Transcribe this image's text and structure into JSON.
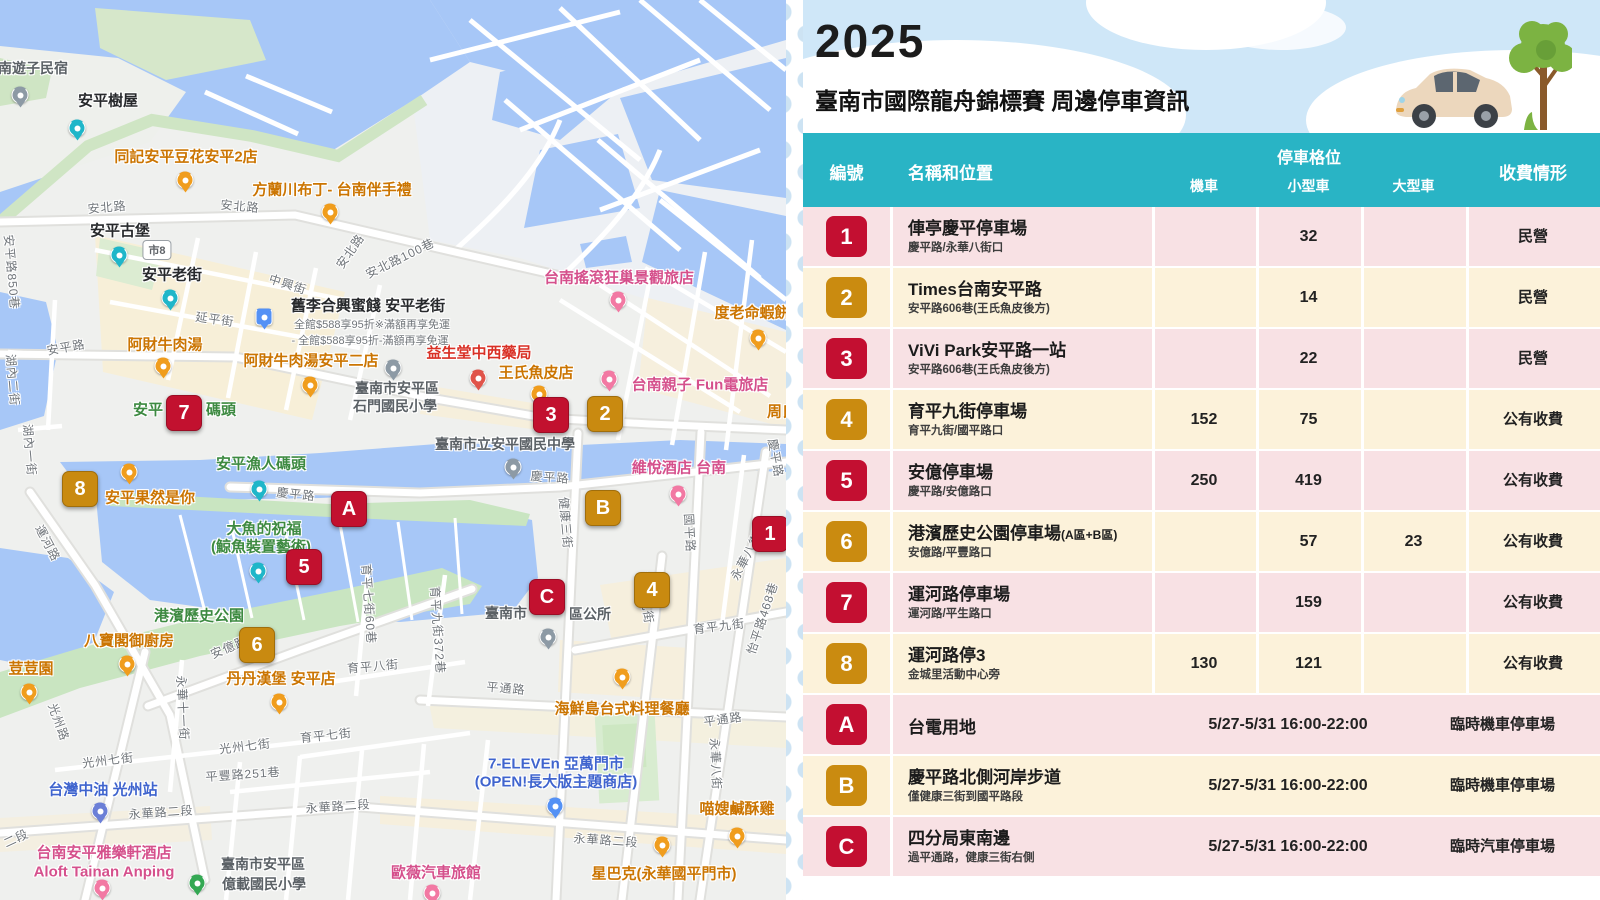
{
  "poster": {
    "year": "2025",
    "title": "臺南市國際龍舟錦標賽 周邊停車資訊",
    "header": {
      "id": "編號",
      "name": "名稱和位置",
      "group": "停車格位",
      "moto": "機車",
      "small": "小型車",
      "large": "大型車",
      "fee": "收費情形"
    },
    "colors": {
      "teal": "#29b4c5",
      "badge_red": "#c30f31",
      "badge_gold": "#ca8b10",
      "row_pink": "#f8e1e4",
      "row_cream": "#fcf2da",
      "sky": "#cfe7f8"
    },
    "rows": [
      {
        "id": "1",
        "color": "red",
        "name": "俥亭慶平停車場",
        "sub": "慶平路/永華八街口",
        "moto": "",
        "small": "32",
        "large": "",
        "fee": "民營"
      },
      {
        "id": "2",
        "color": "gold",
        "name": "Times台南安平路",
        "sub": "安平路606巷(王氏魚皮後方)",
        "moto": "",
        "small": "14",
        "large": "",
        "fee": "民營"
      },
      {
        "id": "3",
        "color": "red",
        "name": "ViVi Park安平路一站",
        "sub": "安平路606巷(王氏魚皮後方)",
        "moto": "",
        "small": "22",
        "large": "",
        "fee": "民營"
      },
      {
        "id": "4",
        "color": "gold",
        "name": "育平九街停車場",
        "sub": "育平九街/國平路口",
        "moto": "152",
        "small": "75",
        "large": "",
        "fee": "公有收費"
      },
      {
        "id": "5",
        "color": "red",
        "name": "安億停車場",
        "sub": "慶平路/安億路口",
        "moto": "250",
        "small": "419",
        "large": "",
        "fee": "公有收費"
      },
      {
        "id": "6",
        "color": "gold",
        "name": "港濱歷史公園停車場",
        "name_suffix": "(A區+B區)",
        "sub": "安億路/平豐路口",
        "moto": "",
        "small": "57",
        "large": "23",
        "fee": "公有收費"
      },
      {
        "id": "7",
        "color": "red",
        "name": "運河路停車場",
        "sub": "運河路/平生路口",
        "moto": "",
        "small": "159",
        "large": "",
        "fee": "公有收費"
      },
      {
        "id": "8",
        "color": "gold",
        "name": "運河路停3",
        "sub": "金城里活動中心旁",
        "moto": "130",
        "small": "121",
        "large": "",
        "fee": "公有收費"
      },
      {
        "id": "A",
        "color": "red",
        "name": "台電用地",
        "sub": "",
        "time": "5/27-5/31 16:00-22:00",
        "fee": "臨時機車停車場"
      },
      {
        "id": "B",
        "color": "gold",
        "name": "慶平路北側河岸步道",
        "sub": "僅健康三街到國平路段",
        "time": "5/27-5/31 16:00-22:00",
        "fee": "臨時機車停車場"
      },
      {
        "id": "C",
        "color": "red",
        "name": "四分局東南邊",
        "sub": "過平通路，健康三街右側",
        "time": "5/27-5/31 16:00-22:00",
        "fee": "臨時汽車停車場"
      }
    ],
    "illustration": [
      "car-illustration",
      "tree-illustration"
    ]
  },
  "map": {
    "shield": {
      "text": "市8",
      "x": 157,
      "y": 250
    },
    "markers": [
      {
        "label": "1",
        "color": "red",
        "x": 770,
        "y": 534
      },
      {
        "label": "2",
        "color": "gold",
        "x": 605,
        "y": 414
      },
      {
        "label": "3",
        "color": "red",
        "x": 551,
        "y": 415
      },
      {
        "label": "4",
        "color": "gold",
        "x": 652,
        "y": 590
      },
      {
        "label": "5",
        "color": "red",
        "x": 304,
        "y": 567
      },
      {
        "label": "6",
        "color": "gold",
        "x": 257,
        "y": 645
      },
      {
        "label": "7",
        "color": "red",
        "x": 184,
        "y": 413
      },
      {
        "label": "8",
        "color": "gold",
        "x": 80,
        "y": 489
      },
      {
        "label": "A",
        "color": "red",
        "x": 349,
        "y": 509
      },
      {
        "label": "B",
        "color": "gold",
        "x": 603,
        "y": 508
      },
      {
        "label": "C",
        "color": "red",
        "x": 547,
        "y": 597
      }
    ],
    "labels": [
      {
        "t": "安北路",
        "x": 107,
        "y": 207,
        "c": "road",
        "r": -5
      },
      {
        "t": "安北路",
        "x": 240,
        "y": 206,
        "c": "road",
        "r": 5
      },
      {
        "t": "安北路",
        "x": 350,
        "y": 251,
        "c": "road",
        "r": -55
      },
      {
        "t": "安北路100巷",
        "x": 400,
        "y": 258,
        "c": "road",
        "r": -26
      },
      {
        "t": "中興街",
        "x": 288,
        "y": 284,
        "c": "road",
        "r": 18
      },
      {
        "t": "延平街",
        "x": 215,
        "y": 319,
        "c": "road",
        "r": 8
      },
      {
        "t": "安平路850巷",
        "x": 12,
        "y": 272,
        "c": "road",
        "r": 85
      },
      {
        "t": "安平路",
        "x": 66,
        "y": 347,
        "c": "road",
        "r": -10
      },
      {
        "t": "湖內二街",
        "x": 13,
        "y": 380,
        "c": "road",
        "r": 85
      },
      {
        "t": "湖內一街",
        "x": 30,
        "y": 450,
        "c": "road",
        "r": 85
      },
      {
        "t": "運河路",
        "x": 48,
        "y": 543,
        "c": "road",
        "r": 62
      },
      {
        "t": "慶平路",
        "x": 296,
        "y": 494,
        "c": "road",
        "r": 6
      },
      {
        "t": "慶平路",
        "x": 550,
        "y": 477,
        "c": "road",
        "r": 4
      },
      {
        "t": "慶平路",
        "x": 776,
        "y": 458,
        "c": "road",
        "r": 80
      },
      {
        "t": "健康三街",
        "x": 566,
        "y": 523,
        "c": "road",
        "r": 85
      },
      {
        "t": "國平路",
        "x": 690,
        "y": 533,
        "c": "road",
        "r": 87
      },
      {
        "t": "永華八街",
        "x": 746,
        "y": 556,
        "c": "road",
        "r": -62
      },
      {
        "t": "永華八街",
        "x": 716,
        "y": 764,
        "c": "road",
        "r": 87
      },
      {
        "t": "怡平路468巷",
        "x": 762,
        "y": 618,
        "c": "road",
        "r": -72
      },
      {
        "t": "育平九街",
        "x": 719,
        "y": 626,
        "c": "road",
        "r": -7
      },
      {
        "t": "育平九街",
        "x": 646,
        "y": 598,
        "c": "road",
        "r": 82
      },
      {
        "t": "育平九街372巷",
        "x": 438,
        "y": 630,
        "c": "road",
        "r": 86
      },
      {
        "t": "平通路",
        "x": 506,
        "y": 688,
        "c": "road",
        "r": 5
      },
      {
        "t": "平通路",
        "x": 723,
        "y": 719,
        "c": "road",
        "r": -8
      },
      {
        "t": "永華路二段",
        "x": 161,
        "y": 812,
        "c": "road",
        "r": -4
      },
      {
        "t": "永華路二段",
        "x": 338,
        "y": 806,
        "c": "road",
        "r": -4
      },
      {
        "t": "永華路二段",
        "x": 606,
        "y": 840,
        "c": "road",
        "r": 4
      },
      {
        "t": "二段",
        "x": 16,
        "y": 838,
        "c": "road",
        "r": -25
      },
      {
        "t": "光州路",
        "x": 59,
        "y": 722,
        "c": "road",
        "r": 70
      },
      {
        "t": "永華十一街",
        "x": 183,
        "y": 708,
        "c": "road",
        "r": 87
      },
      {
        "t": "光州七街",
        "x": 108,
        "y": 760,
        "c": "road",
        "r": -7
      },
      {
        "t": "光州七街",
        "x": 245,
        "y": 746,
        "c": "road",
        "r": -7
      },
      {
        "t": "平豐路251巷",
        "x": 243,
        "y": 774,
        "c": "road",
        "r": -4
      },
      {
        "t": "育平七街60巷",
        "x": 369,
        "y": 604,
        "c": "road",
        "r": 86
      },
      {
        "t": "育平八街",
        "x": 373,
        "y": 666,
        "c": "road",
        "r": -5
      },
      {
        "t": "育平七街",
        "x": 326,
        "y": 735,
        "c": "road",
        "r": -6
      },
      {
        "t": "安億路",
        "x": 229,
        "y": 647,
        "c": "road",
        "r": -23
      },
      {
        "t": "同記安平豆花安平2店",
        "x": 186,
        "y": 156,
        "c": "food",
        "r": 0
      },
      {
        "t": "方蘭川布丁- 台南伴手禮",
        "x": 332,
        "y": 189,
        "c": "food",
        "r": 0
      },
      {
        "t": "阿財牛肉湯",
        "x": 165,
        "y": 344,
        "c": "food",
        "r": 0
      },
      {
        "t": "阿財牛肉湯安平二店",
        "x": 311,
        "y": 360,
        "c": "food",
        "r": 0
      },
      {
        "t": "王氏魚皮店",
        "x": 536,
        "y": 372,
        "c": "food",
        "r": 0
      },
      {
        "t": "度老命蝦餅",
        "x": 752,
        "y": 312,
        "c": "food",
        "r": 0
      },
      {
        "t": "海鮮島台式料理餐廳",
        "x": 622,
        "y": 708,
        "c": "food",
        "r": 0
      },
      {
        "t": "八寶閣御廚房",
        "x": 129,
        "y": 640,
        "c": "food",
        "r": 0
      },
      {
        "t": "荳荳園",
        "x": 31,
        "y": 668,
        "c": "food",
        "r": 0
      },
      {
        "t": "丹丹漢堡 安平店",
        "x": 281,
        "y": 678,
        "c": "food",
        "r": 0
      },
      {
        "t": "喵嫂鹹酥雞",
        "x": 737,
        "y": 808,
        "c": "food",
        "r": 0
      },
      {
        "t": "星巴克(永華國平門市)",
        "x": 664,
        "y": 873,
        "c": "food",
        "r": 0
      },
      {
        "t": "安平果然是你",
        "x": 150,
        "y": 497,
        "c": "food",
        "r": 0
      },
      {
        "t": "周氏",
        "x": 782,
        "y": 411,
        "c": "food",
        "r": 0
      },
      {
        "t": "益生堂中西藥局",
        "x": 479,
        "y": 352,
        "c": "red",
        "r": 0
      },
      {
        "t": "台南搖滾狂巢景觀旅店",
        "x": 619,
        "y": 277,
        "c": "hotel",
        "r": 0
      },
      {
        "t": "台南親子 Fun電旅店",
        "x": 700,
        "y": 384,
        "c": "hotel",
        "r": 0
      },
      {
        "t": "維悅酒店 台南",
        "x": 679,
        "y": 467,
        "c": "hotel",
        "r": 0
      },
      {
        "t": "歐薇汽車旅館",
        "x": 436,
        "y": 872,
        "c": "hotel",
        "r": 0
      },
      {
        "t": "台南安平雅樂軒酒店",
        "x": 104,
        "y": 852,
        "c": "hotel",
        "r": 0
      },
      {
        "t": "Aloft Tainan Anping",
        "x": 104,
        "y": 872,
        "c": "hotel",
        "r": 0
      },
      {
        "t": "港濱歷史公園",
        "x": 199,
        "y": 615,
        "c": "park",
        "r": 0
      },
      {
        "t": "安平漁人碼頭",
        "x": 261,
        "y": 463,
        "c": "park",
        "r": 0
      },
      {
        "t": "大魚的祝福",
        "x": 264,
        "y": 528,
        "c": "park",
        "r": 0
      },
      {
        "t": "(鯨魚裝置藝術)",
        "x": 261,
        "y": 546,
        "c": "park",
        "r": 0
      },
      {
        "t": "安平",
        "x": 148,
        "y": 409,
        "c": "park",
        "r": 0
      },
      {
        "t": "碼頭",
        "x": 221,
        "y": 409,
        "c": "park",
        "r": 0
      },
      {
        "t": "台灣中油 光州站",
        "x": 103,
        "y": 789,
        "c": "blue",
        "r": 0
      },
      {
        "t": "7-ELEVEn 亞萬門市",
        "x": 556,
        "y": 763,
        "c": "blue",
        "r": 0
      },
      {
        "t": "(OPEN!長大版主題商店)",
        "x": 556,
        "y": 781,
        "c": "blue",
        "r": 0
      },
      {
        "t": "臺南市安平區",
        "x": 397,
        "y": 388,
        "c": "civic",
        "r": 0
      },
      {
        "t": "石門國民小學",
        "x": 395,
        "y": 406,
        "c": "civic",
        "r": 0
      },
      {
        "t": "臺南市立安平國民中學",
        "x": 505,
        "y": 444,
        "c": "civic",
        "r": 0
      },
      {
        "t": "臺南市",
        "x": 506,
        "y": 613,
        "c": "civic",
        "r": 0
      },
      {
        "t": "區公所",
        "x": 590,
        "y": 614,
        "c": "civic",
        "r": 0
      },
      {
        "t": "臺南市安平區",
        "x": 263,
        "y": 864,
        "c": "civic",
        "r": 0
      },
      {
        "t": "億載國民小學",
        "x": 264,
        "y": 884,
        "c": "civic",
        "r": 0
      },
      {
        "t": "南遊子民宿",
        "x": 33,
        "y": 68,
        "c": "civic",
        "r": 0
      },
      {
        "t": "安平樹屋",
        "x": 108,
        "y": 100,
        "c": "dark",
        "r": 0
      },
      {
        "t": "安平古堡",
        "x": 120,
        "y": 230,
        "c": "dark",
        "r": 0
      },
      {
        "t": "安平老街",
        "x": 172,
        "y": 274,
        "c": "dark",
        "r": 0
      },
      {
        "t": "舊李合興蜜餞 安平老街",
        "x": 368,
        "y": 305,
        "c": "dark",
        "r": 0
      },
      {
        "t": "全館$588享95折※滿額再享免運",
        "x": 372,
        "y": 324,
        "c": "sub",
        "r": 0
      },
      {
        "t": "- 全館$588享95折-滿額再享免運",
        "x": 370,
        "y": 340,
        "c": "sub",
        "r": 0
      }
    ],
    "pins": [
      {
        "x": 20,
        "y": 95,
        "t": "lodge",
        "n": "guesthouse-pin"
      },
      {
        "x": 77,
        "y": 128,
        "t": "camera",
        "n": "anping-treehouse-pin"
      },
      {
        "x": 185,
        "y": 180,
        "t": "food",
        "n": "tongji-tofu-pudding-pin"
      },
      {
        "x": 330,
        "y": 212,
        "t": "food",
        "n": "fanglanchuan-pudding-pin"
      },
      {
        "x": 119,
        "y": 255,
        "t": "camera",
        "n": "anping-fort-pin"
      },
      {
        "x": 170,
        "y": 298,
        "t": "camera",
        "n": "anping-old-street-pin"
      },
      {
        "x": 264,
        "y": 317,
        "t": "shop",
        "n": "preserved-fruit-shop-pin"
      },
      {
        "x": 163,
        "y": 366,
        "t": "food",
        "n": "acai-beef-soup-pin"
      },
      {
        "x": 310,
        "y": 385,
        "t": "food",
        "n": "acai-beef-soup-2-pin"
      },
      {
        "x": 478,
        "y": 378,
        "t": "pharmacy",
        "n": "pharmacy-pin"
      },
      {
        "x": 539,
        "y": 394,
        "t": "food",
        "n": "wangshi-fish-skin-pin"
      },
      {
        "x": 618,
        "y": 300,
        "t": "hotel",
        "n": "rock-hostel-pin"
      },
      {
        "x": 758,
        "y": 338,
        "t": "food",
        "n": "shrimp-cracker-pin"
      },
      {
        "x": 609,
        "y": 379,
        "t": "hotel",
        "n": "fun-hotel-pin"
      },
      {
        "x": 393,
        "y": 368,
        "t": "school",
        "n": "shimen-elementary-pin"
      },
      {
        "x": 513,
        "y": 467,
        "t": "school",
        "n": "anping-junior-high-pin"
      },
      {
        "x": 129,
        "y": 472,
        "t": "drink",
        "n": "anping-drink-shop-pin"
      },
      {
        "x": 259,
        "y": 489,
        "t": "camera",
        "n": "fisherman-wharf-pin"
      },
      {
        "x": 678,
        "y": 494,
        "t": "hotel",
        "n": "wei-yat-hotel-pin"
      },
      {
        "x": 258,
        "y": 571,
        "t": "camera",
        "n": "whale-art-pin"
      },
      {
        "x": 548,
        "y": 637,
        "t": "civic",
        "n": "district-office-pin"
      },
      {
        "x": 127,
        "y": 664,
        "t": "food",
        "n": "babaoge-restaurant-pin"
      },
      {
        "x": 29,
        "y": 692,
        "t": "food",
        "n": "doudouyuan-pin"
      },
      {
        "x": 279,
        "y": 702,
        "t": "food",
        "n": "dandan-burger-pin"
      },
      {
        "x": 622,
        "y": 677,
        "t": "food",
        "n": "seafood-island-pin"
      },
      {
        "x": 100,
        "y": 811,
        "t": "gas",
        "n": "cpc-gas-station-pin"
      },
      {
        "x": 555,
        "y": 806,
        "t": "store",
        "n": "seven-eleven-pin"
      },
      {
        "x": 737,
        "y": 836,
        "t": "food",
        "n": "salty-chicken-pin"
      },
      {
        "x": 662,
        "y": 845,
        "t": "coffee",
        "n": "starbucks-pin"
      },
      {
        "x": 102,
        "y": 888,
        "t": "hotel",
        "n": "aloft-hotel-pin"
      },
      {
        "x": 432,
        "y": 893,
        "t": "hotel",
        "n": "ouwei-motel-pin"
      },
      {
        "x": 197,
        "y": 883,
        "t": "park",
        "n": "yizai-elementary-pin"
      }
    ]
  }
}
